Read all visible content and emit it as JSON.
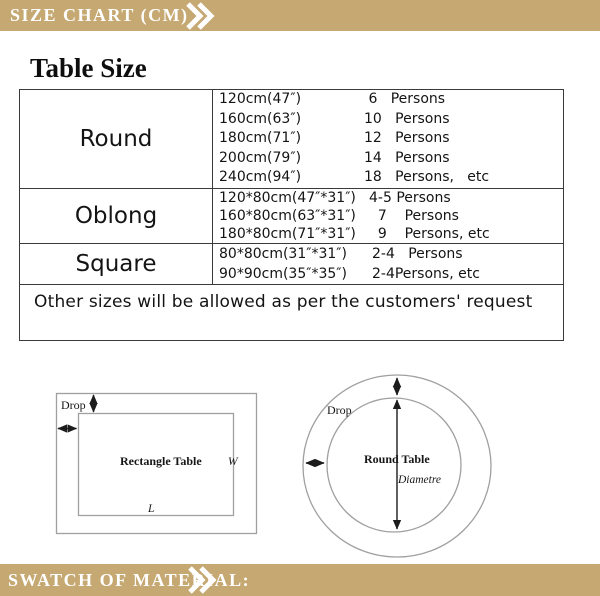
{
  "colors": {
    "banner_background": "#C5A872",
    "banner_text": "#FFFFFF",
    "table_border": "#3A3A3A",
    "diagram_line": "#A0A0A0",
    "arrow_color": "#1C1C1C"
  },
  "header_banner": {
    "title": "SIZE CHART (CM)"
  },
  "footer_banner": {
    "title": "SWATCH OF MATERIAL:"
  },
  "size_table": {
    "title": "Table Size",
    "sections": [
      {
        "label": "Round",
        "rows": [
          {
            "size": "120cm(47″)",
            "persons": " 6   Persons"
          },
          {
            "size": "160cm(63″)",
            "persons": "10   Persons"
          },
          {
            "size": "180cm(71″)",
            "persons": "12   Persons"
          },
          {
            "size": "200cm(79″)",
            "persons": "14   Persons"
          },
          {
            "size": "240cm(94″)",
            "persons": "18   Persons,   etc"
          }
        ]
      },
      {
        "label": "Oblong",
        "rows": [
          {
            "size": "120*80cm(47″*31″)",
            "persons": "4-5 Persons"
          },
          {
            "size": "160*80cm(63″*31″)",
            "persons": "  7    Persons"
          },
          {
            "size": "180*80cm(71″*31″)",
            "persons": "  9    Persons, etc"
          }
        ]
      },
      {
        "label": "Square",
        "rows": [
          {
            "size": "80*80cm(31″*31″)",
            "persons": "2-4   Persons"
          },
          {
            "size": "90*90cm(35″*35″)",
            "persons": "2-4Persons, etc"
          }
        ]
      }
    ],
    "note": "Other sizes will be allowed as per the customers' request"
  },
  "diagrams": {
    "rectangle": {
      "drop": "Drop",
      "name": "Rectangle Table",
      "width_label": "W",
      "length_label": "L"
    },
    "round": {
      "drop": "Drop",
      "name": "Round Table",
      "diameter_label": "Diametre"
    }
  }
}
